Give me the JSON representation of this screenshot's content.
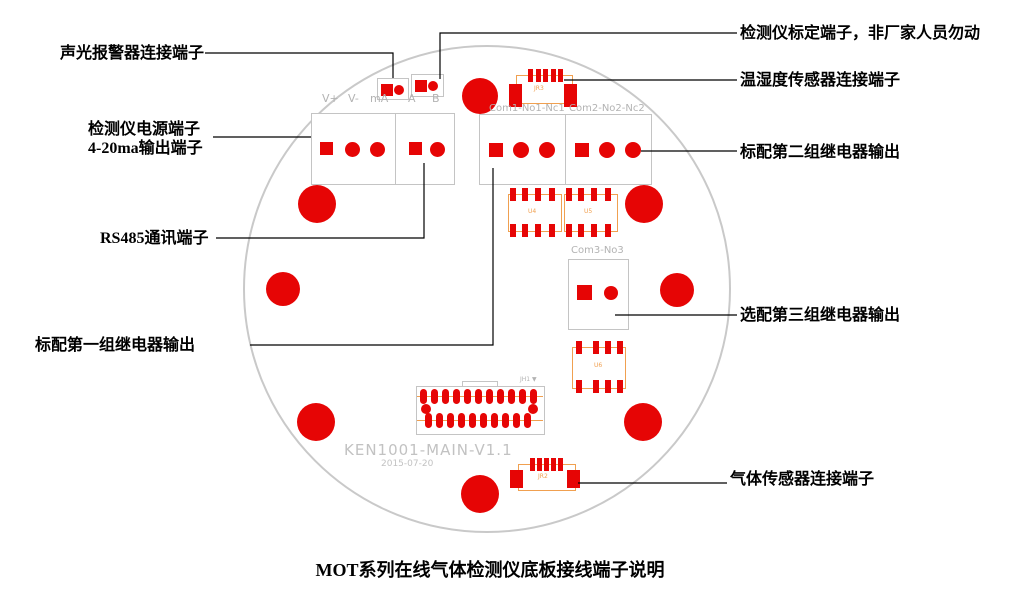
{
  "caption": "MOT系列在线气体检测仪底板接线端子说明",
  "callouts": {
    "alarm": "声光报警器连接端子",
    "power_line1": "检测仪电源端子",
    "power_line2": "4-20ma输出端子",
    "rs485": "RS485通讯端子",
    "relay1": "标配第一组继电器输出",
    "calibration": "检测仪标定端子，非厂家人员勿动",
    "temp_humidity": "温湿度传感器连接端子",
    "relay2": "标配第二组继电器输出",
    "relay3": "选配第三组继电器输出",
    "gas_sensor": "气体传感器连接端子"
  },
  "silkscreen": {
    "terminal_labels": [
      "V+",
      "V-",
      "mA",
      "A",
      "B"
    ],
    "relay12_labels": [
      "Com1-No1-Nc1",
      "Com2-No2-Nc2"
    ],
    "relay3_label": "Com3-No3",
    "board_name": "KEN1001-MAIN-V1.1",
    "board_date": "2015-07-20",
    "jr3": "JR3",
    "jr2": "JR2",
    "jh1": "JH1 ▼",
    "u4": "U4",
    "u5": "U5",
    "u6": "U6"
  },
  "colors": {
    "pad_red": "#e60505",
    "silkscreen_orange": "#f0a050",
    "silkscreen_gray": "#b3b3b3",
    "board_outline_gray": "#c9c9c9",
    "callout_black": "#000000"
  }
}
